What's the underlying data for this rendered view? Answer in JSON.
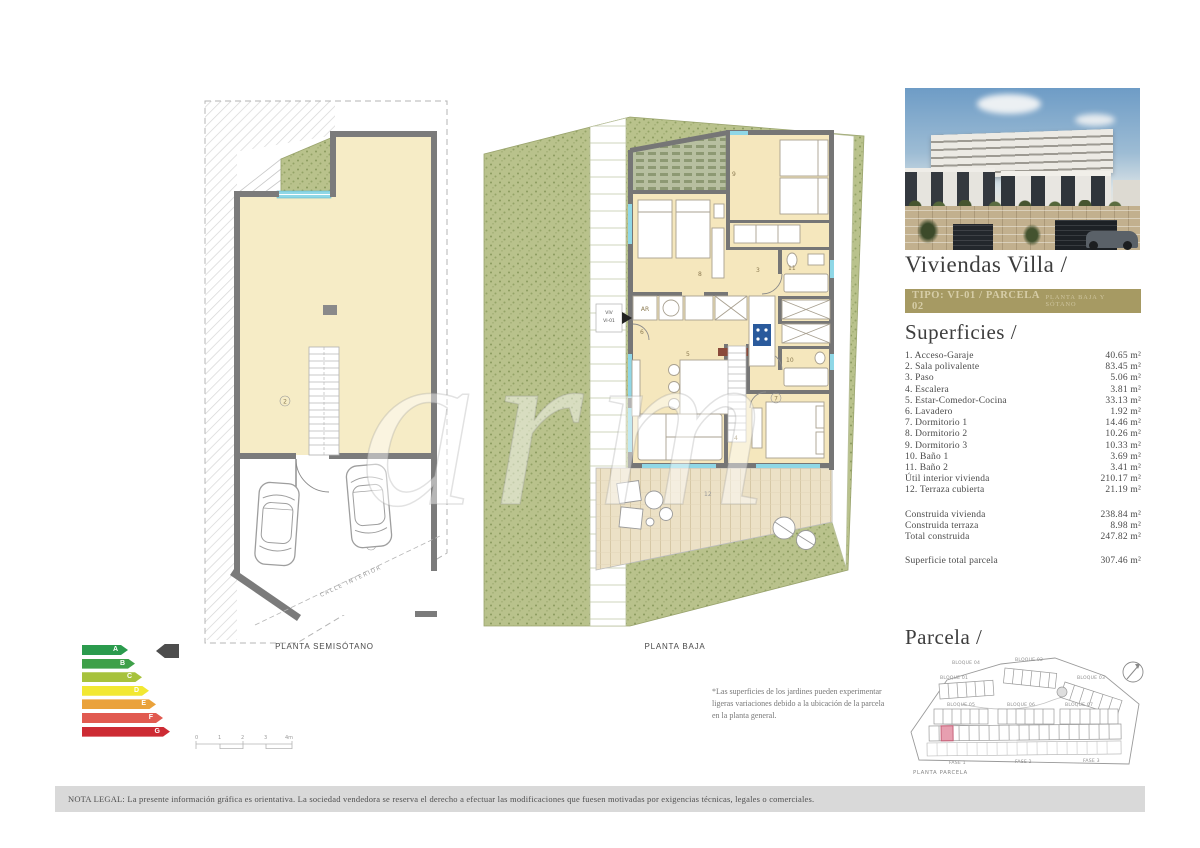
{
  "watermark": "arm",
  "plans": {
    "semisotano": {
      "caption": "PLANTA SEMISÓTANO",
      "street_label": "CALLE INTERIOR",
      "labels": {
        "garage": "1",
        "sala": "2"
      }
    },
    "baja": {
      "caption": "PLANTA BAJA",
      "entry_line1": "VIV",
      "entry_line2": "VI-01",
      "closet_label": "AR",
      "labels": {
        "paso": "3",
        "escalera": "4",
        "estar": "5",
        "lavadero": "6",
        "dorm1": "7",
        "dorm2": "8",
        "dorm3": "9",
        "bano1": "10",
        "bano2": "11",
        "terraza": "12"
      }
    }
  },
  "colors": {
    "banner_gold": "#a69a63",
    "room_cream": "#f5e7bd",
    "wall_gray": "#767676",
    "garden_green": "#b9c28c",
    "window_cyan": "#8fd7e6",
    "deck_wood": "#ece1c6",
    "parcel_highlight": "#e79fb0"
  },
  "energy": {
    "selected": "A",
    "arrow_color": "#4d4d4d",
    "grades": [
      {
        "letter": "A",
        "color": "#2b9b4d",
        "width": "46px"
      },
      {
        "letter": "B",
        "color": "#3ea049",
        "width": "53px"
      },
      {
        "letter": "C",
        "color": "#a7c23c",
        "width": "60px"
      },
      {
        "letter": "D",
        "color": "#f2e832",
        "width": "67px"
      },
      {
        "letter": "E",
        "color": "#eaa23b",
        "width": "74px"
      },
      {
        "letter": "F",
        "color": "#e15a50",
        "width": "81px"
      },
      {
        "letter": "G",
        "color": "#cd2b34",
        "width": "88px"
      }
    ]
  },
  "scalebar": {
    "ticks": [
      "0",
      "1",
      "2",
      "3",
      "4m"
    ]
  },
  "sidebar": {
    "title": "Viviendas Villa /",
    "banner": {
      "left": "TIPO: VI-01 / PARCELA 02",
      "right": "PLANTA BAJA Y SÓTANO"
    },
    "superficies": {
      "heading": "Superficies /",
      "rows": [
        {
          "label": "1. Acceso-Garaje",
          "value": "40.65 m²"
        },
        {
          "label": "2. Sala polivalente",
          "value": "83.45 m²"
        },
        {
          "label": "3. Paso",
          "value": "5.06 m²"
        },
        {
          "label": "4. Escalera",
          "value": "3.81 m²"
        },
        {
          "label": "5. Estar-Comedor-Cocina",
          "value": "33.13 m²"
        },
        {
          "label": "6. Lavadero",
          "value": "1.92 m²"
        },
        {
          "label": "7. Dormitorio 1",
          "value": "14.46 m²"
        },
        {
          "label": "8. Dormitorio 2",
          "value": "10.26 m²"
        },
        {
          "label": "9. Dormitorio 3",
          "value": "10.33 m²"
        },
        {
          "label": "10. Baño 1",
          "value": "3.69 m²"
        },
        {
          "label": "11. Baño 2",
          "value": "3.41 m²"
        },
        {
          "label": "Útil interior vivienda",
          "value": "210.17 m²"
        },
        {
          "label": "12. Terraza cubierta",
          "value": "21.19 m²"
        },
        {
          "label": "Construida vivienda",
          "value": "238.84 m²",
          "gap": true
        },
        {
          "label": "Construida terraza",
          "value": "8.98 m²"
        },
        {
          "label": "Total construida",
          "value": "247.82 m²"
        },
        {
          "label": "Superficie total parcela",
          "value": "307.46 m²",
          "gap": true
        }
      ]
    },
    "parcela": {
      "heading": "Parcela /",
      "caption": "PLANTA PARCELA",
      "blocks": [
        {
          "label": "BLOQUE 04"
        },
        {
          "label": "BLOQUE 02"
        },
        {
          "label": "BLOQUE 03"
        },
        {
          "label": "BLOQUE 01"
        },
        {
          "label": "BLOQUE 05"
        },
        {
          "label": "BLOQUE 06"
        },
        {
          "label": "BLOQUE 07"
        }
      ],
      "fases": [
        {
          "label": "FASE 1"
        },
        {
          "label": "FASE 2"
        },
        {
          "label": "FASE 3"
        }
      ]
    }
  },
  "notes": {
    "gardens": "*Las superficies de los jardines pueden experimentar ligeras variaciones debido a la ubicación de la parcela en la planta general.",
    "legal": "NOTA LEGAL: La presente información gráfica es orientativa. La sociedad vendedora se reserva el derecho a efectuar las modificaciones que fuesen motivadas por exigencias técnicas, legales o comerciales."
  }
}
